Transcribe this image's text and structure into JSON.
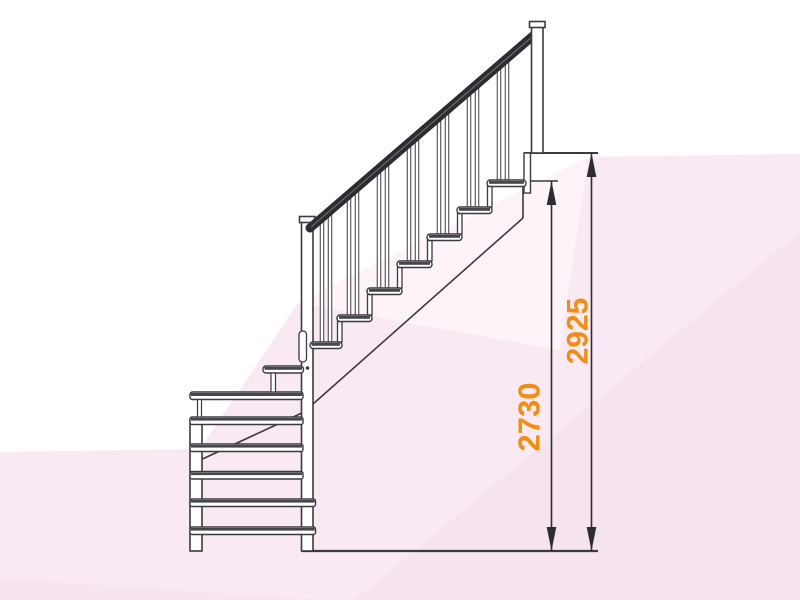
{
  "page": {
    "title": "Правая"
  },
  "diagram": {
    "type": "staircase-side-elevation",
    "stair_direction_label": "Правая",
    "dimensions": [
      {
        "value": "2730"
      },
      {
        "value": "2925"
      }
    ],
    "colors": {
      "dimension_text": "#f28d11",
      "drawing_line": "#3a3a40",
      "tread_band": "#46464c",
      "handrail": "#2c2c31",
      "background_pink_light": "#f8e9f3",
      "background_pink_deep": "#f3dfeb",
      "title_text": "#17171b"
    }
  }
}
